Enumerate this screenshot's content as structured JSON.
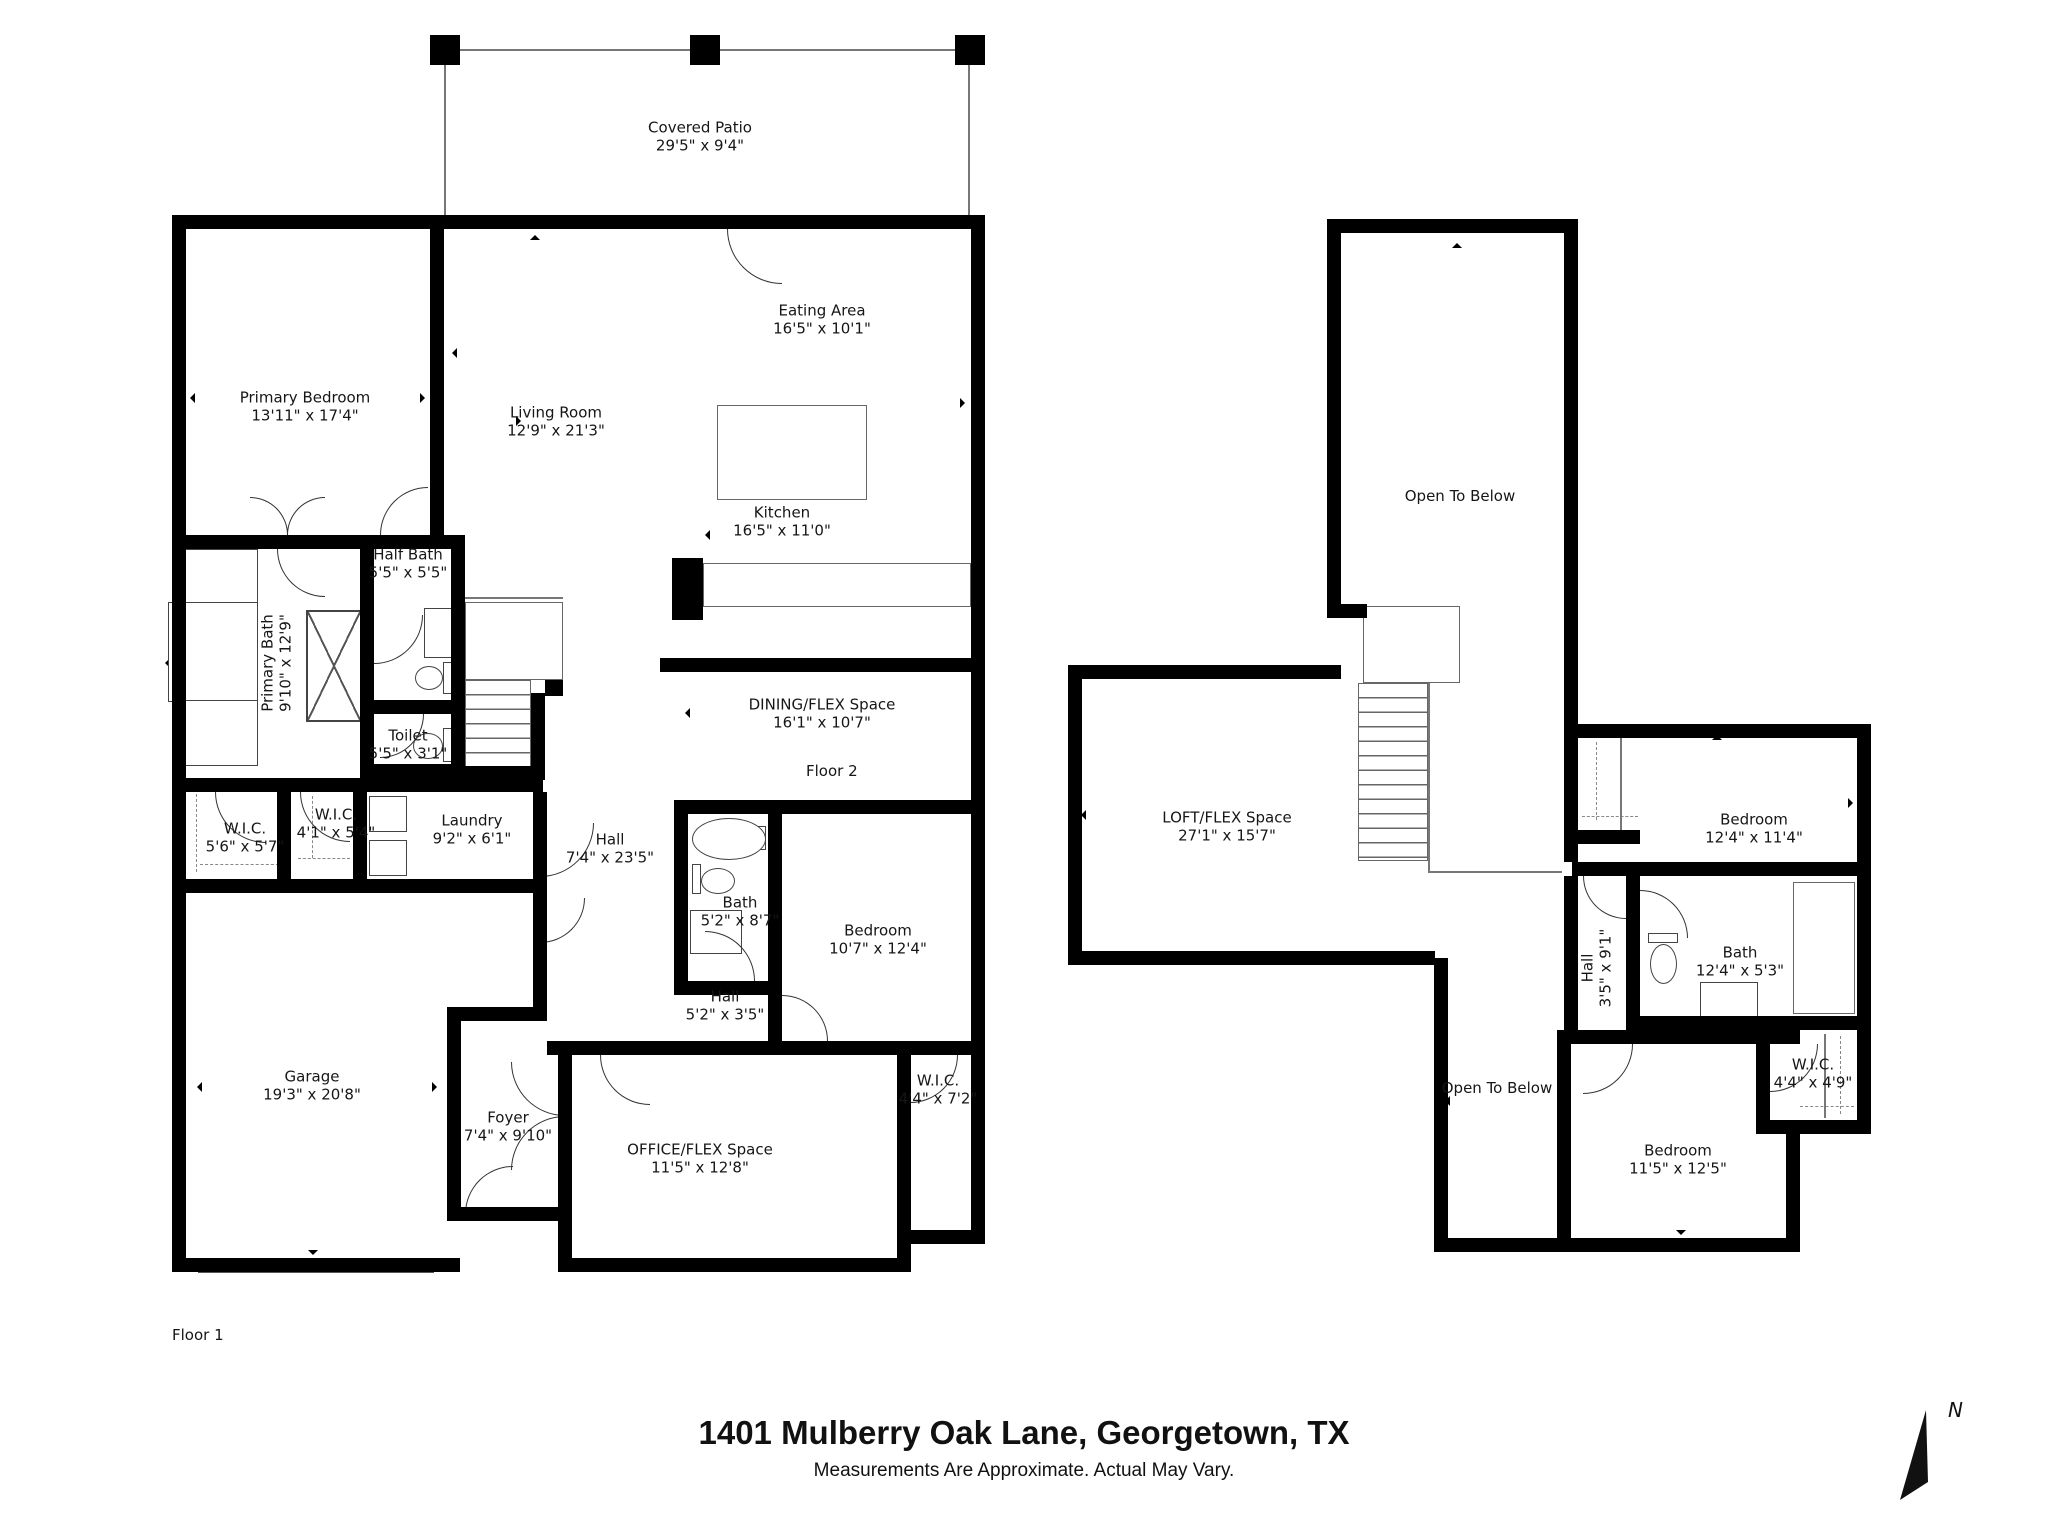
{
  "title": {
    "address": "1401 Mulberry Oak Lane, Georgetown, TX",
    "disclaimer": "Measurements Are Approximate. Actual May Vary."
  },
  "compass": {
    "north": "N"
  },
  "floor1": {
    "label": "Floor 1",
    "rooms": {
      "covered_patio": {
        "name": "Covered Patio",
        "dims": "29'5\" x 9'4\""
      },
      "primary_bedroom": {
        "name": "Primary Bedroom",
        "dims": "13'11\" x 17'4\""
      },
      "living_room": {
        "name": "Living Room",
        "dims": "12'9\" x 21'3\""
      },
      "eating_area": {
        "name": "Eating Area",
        "dims": "16'5\" x 10'1\""
      },
      "kitchen": {
        "name": "Kitchen",
        "dims": "16'5\" x 11'0\""
      },
      "primary_bath": {
        "name": "Primary Bath",
        "dims": "9'10\" x 12'9\""
      },
      "half_bath": {
        "name": "Half Bath",
        "dims": "5'5\" x 5'5\""
      },
      "toilet": {
        "name": "Toilet",
        "dims": "5'5\" x 3'1\""
      },
      "wic_1": {
        "name": "W.I.C.",
        "dims": "5'6\" x 5'7\""
      },
      "wic_2": {
        "name": "W.I.C.",
        "dims": "4'1\" x 5'4\""
      },
      "laundry": {
        "name": "Laundry",
        "dims": "9'2\" x 6'1\""
      },
      "hall": {
        "name": "Hall",
        "dims": "7'4\" x 23'5\""
      },
      "dining_flex": {
        "name": "DINING/FLEX Space",
        "dims": "16'1\" x 10'7\""
      },
      "bath": {
        "name": "Bath",
        "dims": "5'2\" x 8'7\""
      },
      "bedroom": {
        "name": "Bedroom",
        "dims": "10'7\" x 12'4\""
      },
      "hall_2": {
        "name": "Hall",
        "dims": "5'2\" x 3'5\""
      },
      "wic_3": {
        "name": "W.I.C.",
        "dims": "4'4\" x 7'2\""
      },
      "garage": {
        "name": "Garage",
        "dims": "19'3\" x 20'8\""
      },
      "foyer": {
        "name": "Foyer",
        "dims": "7'4\" x 9'10\""
      },
      "office_flex": {
        "name": "OFFICE/FLEX Space",
        "dims": "11'5\" x 12'8\""
      }
    }
  },
  "floor2": {
    "label": "Floor 2",
    "rooms": {
      "open_below_top": {
        "name": "Open To Below"
      },
      "loft_flex": {
        "name": "LOFT/FLEX Space",
        "dims": "27'1\" x 15'7\""
      },
      "bedroom_1": {
        "name": "Bedroom",
        "dims": "12'4\" x 11'4\""
      },
      "hall": {
        "name": "Hall",
        "dims": "3'5\" x 9'1\""
      },
      "bath": {
        "name": "Bath",
        "dims": "12'4\" x 5'3\""
      },
      "wic": {
        "name": "W.I.C.",
        "dims": "4'4\" x 4'9\""
      },
      "bedroom_2": {
        "name": "Bedroom",
        "dims": "11'5\" x 12'5\""
      },
      "open_below_bottom": {
        "name": "Open To Below"
      }
    }
  }
}
